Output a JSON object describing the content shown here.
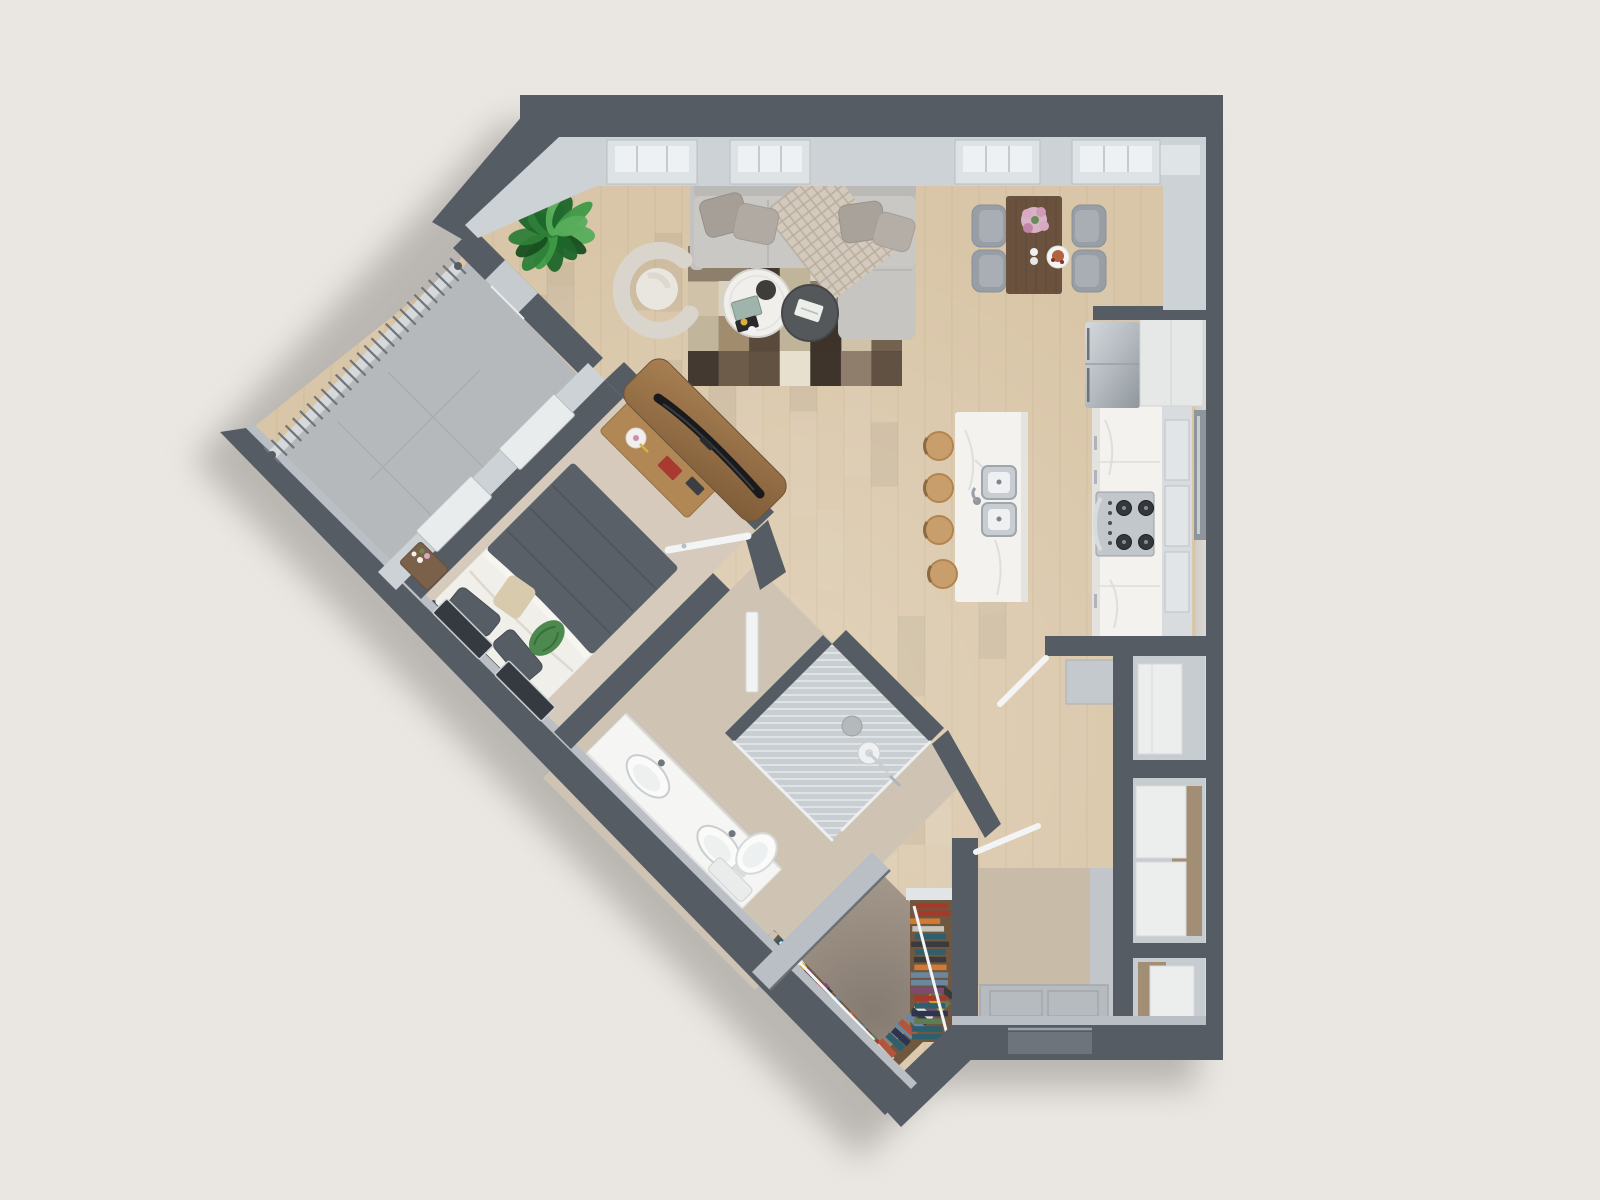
{
  "meta": {
    "kind": "3d-apartment-floorplan-render",
    "canvas": {
      "width": 1600,
      "height": 1200
    },
    "camera": "top-down dollhouse view",
    "visible_text": "none"
  },
  "palette": {
    "bg": "#eae7e2",
    "shadow": "#8b8884",
    "wall": "#565c63",
    "wallFace": "#cdd2d6",
    "wallFaceDim": "#b9bfc5",
    "windowRecess": "#dde2e5",
    "windowPane": "#edf1f4",
    "windowFrame": "#b8bdc2",
    "woodFloor": "#d9c6a8",
    "woodStreak": "#c2ab89",
    "carpet": "#d5cabb",
    "concrete": "#b6b9bb",
    "concreteSeam": "#a5a8aa",
    "bathFloor": "#cfc4b4",
    "showerTile": "#c9ced2",
    "showerStripe": "#dfe3e5",
    "closetFloor": "#a3968a",
    "entryFloor": "#c8bca8",
    "matGray": "#b6bbbf",
    "marble": "#f3f2ef",
    "marbleEdge": "#dddcd8",
    "steelLight": "#d2d6da",
    "steelDark": "#8f969c",
    "white": "#eceeee",
    "glass": "#edf1f3",
    "doorWhite": "#f2f4f5",
    "sofa": "#c9c8c5",
    "sofaBack": "#bab9b6",
    "sofaArm": "#c3c2bf",
    "rugBase": "#cfc2a8",
    "tableWood": "#6a523e",
    "chairGray": "#989ea6",
    "chairSeat": "#a9aeb5",
    "stool": "#c89e6d",
    "stoolEdge": "#b2854f",
    "consoleWood": "#a87f52",
    "deskWood": "#b18756",
    "shelfWood": "#6f5740",
    "duvet": "#5a6067",
    "sheet": "#f1efe9",
    "headboard": "#4a5055",
    "pillowDark": "#575d64",
    "beigePillow": "#d8cbad",
    "greenThrow": "#4e8a50"
  },
  "rooms": [
    {
      "name": "living-room",
      "floor": "wood",
      "features": [
        "sectional-sofa",
        "patchwork-rug",
        "round-coffee-table",
        "round-side-table",
        "barrel-armchair",
        "potted-plant",
        "tv-console",
        "3-windows-top-wall"
      ]
    },
    {
      "name": "dining-nook",
      "floor": "wood",
      "features": [
        "rect-table",
        "4-chairs",
        "flower-centerpiece",
        "plate"
      ]
    },
    {
      "name": "kitchen",
      "floor": "wood",
      "features": [
        "marble-island",
        "double-sink",
        "4-wood-stools",
        "fridge",
        "gas-cooktop",
        "counter-run",
        "window-slot"
      ]
    },
    {
      "name": "bedroom",
      "floor": "carpet",
      "rotated": true,
      "features": [
        "queen-bed",
        "nightstand",
        "desk",
        "2-wall-windows"
      ]
    },
    {
      "name": "bathroom",
      "rotated": true,
      "features": [
        "double-vanity",
        "toilet",
        "walk-in-shower"
      ]
    },
    {
      "name": "walk-in-closet",
      "rotated": true,
      "features": [
        "book-shelves",
        "hanging-rods"
      ]
    },
    {
      "name": "balcony",
      "floor": "concrete",
      "rotated": true,
      "features": [
        "slat-railing",
        "sliding-door"
      ]
    },
    {
      "name": "entry",
      "floor": "tile",
      "features": [
        "door-mat",
        "utility-closets",
        "stacked-laundry"
      ]
    }
  ],
  "counts": {
    "top_windows": 4,
    "dining_chairs": 4,
    "island_stools": 4,
    "sofa_pillows": 4,
    "bedroom_wall_windows": 2,
    "utility_compartments": 3
  },
  "decor": {
    "planks": {
      "x1": 250,
      "x2": 1195,
      "y1": 140,
      "y2": 1100,
      "step": 27,
      "opacity": 0.28,
      "blotches": 70,
      "seed": 3
    },
    "rug": {
      "x": 688,
      "y": 246,
      "w": 214,
      "h": 140,
      "cols": 7,
      "rows": 4,
      "seed": 11,
      "colors": [
        "#3a3028",
        "#6b5a47",
        "#8a7a68",
        "#a08a6c",
        "#d9d2bd",
        "#e8e2d2",
        "#bfb49a",
        "#574839"
      ]
    },
    "railing": {
      "x1": 458,
      "y1": 266,
      "x2": 272,
      "y2": 455,
      "slats": 26,
      "slatLen": 22,
      "base": "#d6d9db",
      "slat": "#6e757b"
    },
    "balconySeams": {
      "diag1": [
        760,
        860
      ],
      "diag2": [
        -150,
        -60,
        30
      ]
    },
    "showerStripes": {
      "y1": 646,
      "y2": 840,
      "step": 7
    },
    "blanket": {
      "cx": 830,
      "cy": 232,
      "w": 80,
      "h": 112,
      "rot": -38,
      "cell": 9,
      "base": "#d3c9bc",
      "line": "#b9ad9e"
    },
    "plant": {
      "cx": 553,
      "cy": 233,
      "leaves": 15,
      "seed": 5,
      "greens": [
        "#1e662a",
        "#2e8038",
        "#3f9a47",
        "#57ad5b",
        "#174f20"
      ]
    },
    "closet": {
      "runs": [
        {
          "x1": 770,
          "y1": 942,
          "x2": 872,
          "y2": 1050,
          "n": 22
        },
        {
          "x1": 884,
          "y1": 1052,
          "x2": 946,
          "y2": 992,
          "n": 13
        }
      ],
      "stack": {
        "x": 913,
        "y": 903,
        "n": 18,
        "step": 7.7,
        "w": 30,
        "h": 5.5
      },
      "bookLen": 21,
      "bookW": 6.5,
      "seed": 9,
      "colors": [
        "#a33b2b",
        "#d07a35",
        "#2e5f6e",
        "#2b3450",
        "#c9a23c",
        "#e9e5da",
        "#5d7d55",
        "#7d4b6e",
        "#3b3b3e",
        "#b4543a",
        "#6b86a0",
        "#c7c3b8"
      ]
    }
  }
}
